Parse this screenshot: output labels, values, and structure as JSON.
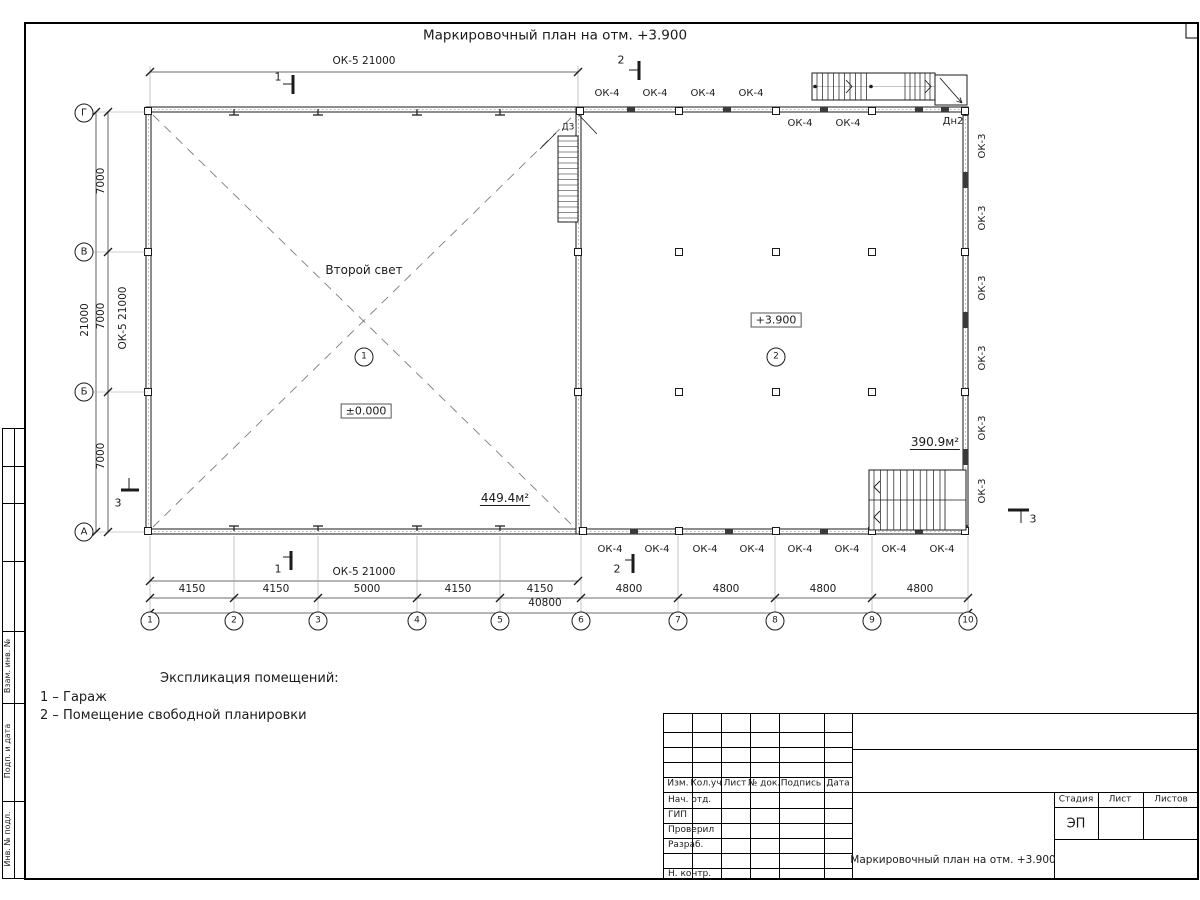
{
  "sheet": {
    "title": "Маркировочный план на отм. +3.900"
  },
  "plan": {
    "second_light": "Второй свет",
    "room1": "1",
    "room2": "2",
    "elev_zero": "±0.000",
    "elev_390": "+3.900",
    "area_room1": "449.4м²",
    "area_room2": "390.9м²",
    "stair_door": "Д3",
    "door2": "Дн2",
    "ok5_top": "ОК-5 21000",
    "ok5_left": "ОК-5 21000",
    "ok5_bottom": "ОК-5 21000",
    "ok4_top_outer": [
      "ОК-4",
      "ОК-4",
      "ОК-4",
      "ОК-4"
    ],
    "ok4_top_inner": [
      "ОК-4",
      "ОК-4"
    ],
    "ok4_bottom": [
      "ОК-4",
      "ОК-4",
      "ОК-4",
      "ОК-4",
      "ОК-4",
      "ОК-4",
      "ОК-4",
      "ОК-4"
    ],
    "ok3_right": [
      "ОК-3",
      "ОК-3",
      "ОК-3",
      "ОК-3",
      "ОК-3",
      "ОК-3"
    ],
    "sec1": "1",
    "sec2": "2",
    "sec3": "3"
  },
  "axes": {
    "cols": [
      "1",
      "2",
      "3",
      "4",
      "5",
      "6",
      "7",
      "8",
      "9",
      "10"
    ],
    "rows": [
      "Г",
      "В",
      "Б",
      "А"
    ],
    "col_dims": [
      "4150",
      "4150",
      "5000",
      "4150",
      "4150",
      "4800",
      "4800",
      "4800",
      "4800"
    ],
    "col_total": "40800",
    "row_dims": [
      "7000",
      "7000",
      "7000"
    ],
    "row_total": "21000"
  },
  "legend": {
    "heading": "Экспликация помещений:",
    "item1": "1 – Гараж",
    "item2": "2 – Помещение свободной планировки"
  },
  "frame_strip": {
    "labels": [
      "Взам. инв. №",
      "Подп. и дата",
      "Инв. № подл."
    ]
  },
  "titleblock": {
    "cols": [
      "Изм.",
      "Кол.уч",
      "Лист",
      "№ док.",
      "Подпись",
      "Дата"
    ],
    "rows": [
      "Нач. отд.",
      "ГИП",
      "Проверил",
      "Разраб.",
      "Н. контр."
    ],
    "stage_label": "Стадия",
    "sheet_label": "Лист",
    "sheets_label": "Листов",
    "stage": "ЭП",
    "doc_title": "Маркировочный план на отм. +3.900"
  }
}
